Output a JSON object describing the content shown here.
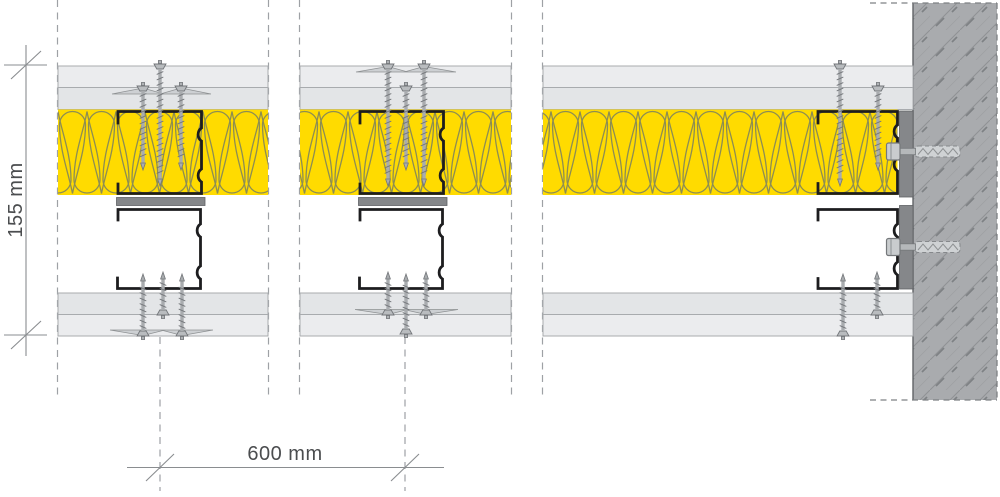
{
  "drawing": {
    "type": "wall-construction-section-detail",
    "dimension_thickness": {
      "label": "155 mm",
      "value": 155,
      "unit": "mm",
      "orientation": "vertical"
    },
    "dimension_spacing": {
      "label": "600 mm",
      "value": 600,
      "unit": "mm",
      "orientation": "horizontal"
    }
  },
  "colors": {
    "insulation_yellow": "#FFDB00",
    "insulation_hatch": "#8D8D52",
    "board_outer": "#EBECEE",
    "board_inner": "#E3E5E7",
    "board_outline": "#A8ABAE",
    "profile_black": "#1D1D1F",
    "steel_bar_gray": "#85878A",
    "steel_bar_edge": "#5F6164",
    "concrete_gray": "#A9ABAE",
    "concrete_hatch": "#8F9194",
    "concrete_hatch_dark": "#7E8184",
    "screw_gray": "#B0B3B6",
    "screw_outline": "#73767A",
    "joint_filler": "#CDD0D3",
    "dimension_line": "#8A8D90",
    "dimension_text": "#4B4D4F",
    "centerline_gray": "#9EA1A5"
  }
}
